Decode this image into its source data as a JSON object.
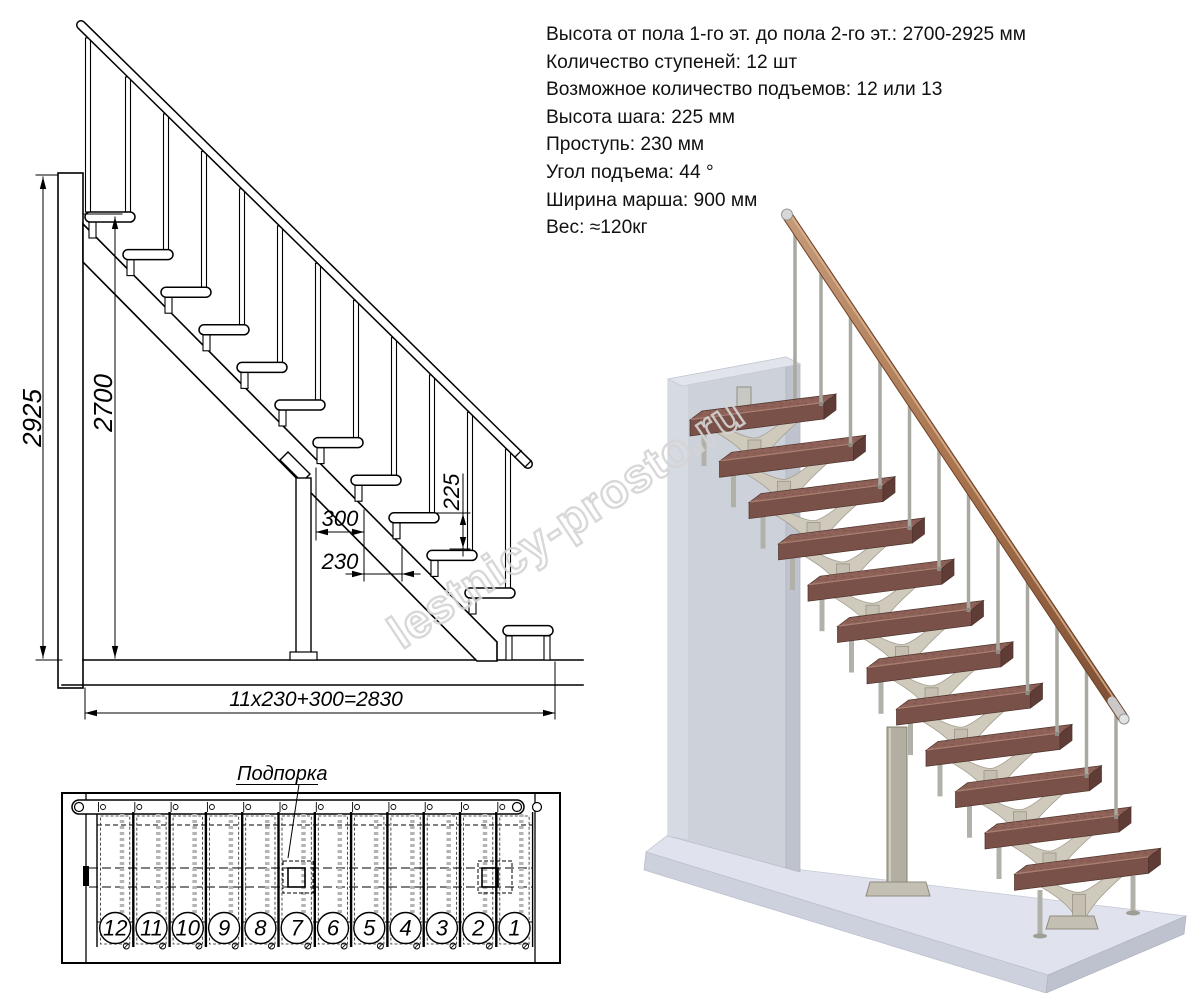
{
  "specs": {
    "lines": [
      "Высота от пола 1-го эт. до пола 2-го эт.: 2700-2925 мм",
      "Количество ступеней: 12 шт",
      "Возможное количество подъемов: 12 или 13",
      "Высота шага: 225 мм",
      "Проступь: 230 мм",
      "Угол подъема: 44 °",
      "Ширина марша: 900 мм",
      "Вес: ≈120кг"
    ]
  },
  "side_view": {
    "dims": {
      "total_height_mm": "2925",
      "floor_to_floor_mm": "2700",
      "riser_mm": "225",
      "bottom_module_mm": "300",
      "tread_run_mm": "230",
      "total_run_formula": "11x230+300=2830"
    }
  },
  "plan_view": {
    "support_label": "Подпорка",
    "step_numbers": [
      "12",
      "11",
      "10",
      "9",
      "8",
      "7",
      "6",
      "5",
      "4",
      "3",
      "2",
      "1"
    ]
  },
  "watermark": {
    "text": "lestnicy-prosto.ru"
  },
  "colors": {
    "drawing_line": "#000000",
    "tread_wood": "#8d6157",
    "tread_front": "#7a5148",
    "handrail_wood": "#a9744e",
    "metal_light": "#b1b1a9",
    "bracket_metal": "#cfcabc",
    "wall_gray": "#cdd1da",
    "floor_gray": "#e0e3ed",
    "watermark_gray": "#d4d4d4"
  }
}
